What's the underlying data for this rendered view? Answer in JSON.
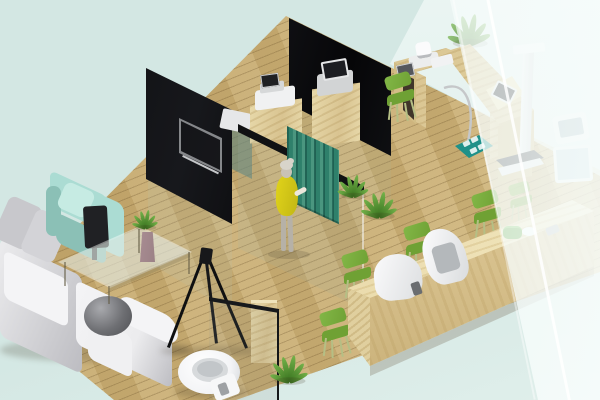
{
  "scene": {
    "type": "3d-isometric-interior-render",
    "setting": "Isometric 3D rendering of a clinic-style office interior floating on a pale mint background",
    "rooms": [
      "lounge with sectional sofa and armchair",
      "consultation rooms behind dark glass partitions",
      "examination area with medical devices",
      "restroom with toilet",
      "reception area with waiting chairs and long wooden counter"
    ],
    "objects": [
      "Wooden plank floor",
      "Frosted glass back wall",
      "Dark glass partition with TV",
      "Dark glass partition",
      "Wall-mounted TV",
      "Privacy curtain",
      "Standing person in yellow dress",
      "L-shaped sectional sofa",
      "Mint green armchair",
      "Glass coffee table with plant vase",
      "Tripod floor stand",
      "Toilet",
      "Bathroom glass partition",
      "Reception counter",
      "Green waiting chair",
      "Reception counter terminal",
      "Examination desk with medical devices",
      "Height measurement stand",
      "Potted plant",
      "Device cabinet with printer",
      "Frosted glass front wall",
      "Weighing mat with pads",
      "Dark display panel",
      "Ball lamp on side table",
      "Wooden bathroom cabinet",
      "Shelf and monitors behind glass"
    ]
  },
  "palette": {
    "bg": "#d3e7e3",
    "bg-soft": "#e0efeb",
    "floor": "#cbb076",
    "floor-dark": "#c2a468",
    "floor-light": "#d9c58c",
    "wood-mid": "#d9c491",
    "wood-light": "#e7d8a9",
    "counter-top": "#f2e7c0",
    "counter-face": "#ecdcae",
    "exam-wood": "#e8d7a6",
    "exam-shade": "#d2bd86",
    "wall-black": "#0a0a0c",
    "curtain": "#2f806b",
    "curtain-dark": "#1f6152",
    "curtain-light": "#4a967f",
    "leaf-dark": "#39731f",
    "leaf-light": "#74b24a",
    "chair-green": "#6fa134",
    "chair-green-light": "#82b747",
    "chair-leg": "#b5bf85",
    "mint": "#abdcd3",
    "mint-dark": "#8bc0b6",
    "mint-light": "#c6ebe3",
    "sofa-white": "#ececee",
    "sofa-light": "#f4f4f6",
    "sofa-gray": "#c8c8cc",
    "sofa-shade": "#bcbcc1",
    "yellow": "#e0d31a",
    "yellow-dark": "#c2b714",
    "skin": "#c9c2b5",
    "hair": "#d8d4ca",
    "leg-gray": "#b6b1a7",
    "toilet": "#f3f4f6",
    "teal-mat": "#1f9189",
    "vase": "#9b8186",
    "silver": "#c5c7c9",
    "device-dark": "#202124",
    "shadow": "rgba(70,60,40,0.22)"
  }
}
